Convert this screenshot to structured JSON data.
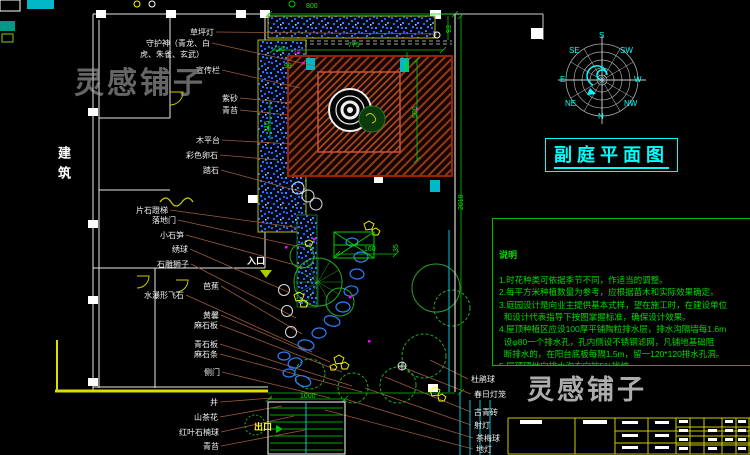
{
  "title": {
    "text": "副庭平面图"
  },
  "building_label": {
    "text": "建筑"
  },
  "entrance": {
    "t": "入口",
    "x": 247,
    "y": 257
  },
  "exit": {
    "t": "出口",
    "x": 254,
    "y": 423
  },
  "watermarks": [
    {
      "t": "灵感铺子",
      "x": 74,
      "y": 58,
      "variant": "dark"
    },
    {
      "t": "灵感铺子",
      "x": 527,
      "y": 368,
      "variant": "light"
    }
  ],
  "notes": {
    "heading": "说明",
    "lines": [
      "1.时花种类可依据季节不同，作适当的调整。",
      "2.每平方米种植数量为参考，应根据苗木和实际效果确定。",
      "3.庭园设计是向业主提供基本式样，望在施工时，在建设单位",
      "  和设计代表指导下按图掌握标准，确保设计效果。",
      "4.屋顶种植区应设100厚平铺陶粒排水层，排水沟隔墙每1.6m",
      "  设φ80一个排水孔，孔内侧设不锈钢滤网，凡铺地基础阻",
      "  断排水的，在阳台底板每隔1.5m，留一120*120排水孔洞。",
      "5.屋顶硬地向排水沟方向按5%找坡。",
      "6.铺地基础详见施工图。"
    ]
  },
  "compass": {
    "dirs": [
      {
        "t": "S",
        "x": 599,
        "y": 32
      },
      {
        "t": "SE",
        "x": 569,
        "y": 47
      },
      {
        "t": "E",
        "x": 560,
        "y": 76
      },
      {
        "t": "NE",
        "x": 565,
        "y": 100
      },
      {
        "t": "N",
        "x": 598,
        "y": 113
      },
      {
        "t": "NW",
        "x": 624,
        "y": 100
      },
      {
        "t": "W",
        "x": 634,
        "y": 76
      },
      {
        "t": "SW",
        "x": 620,
        "y": 47
      }
    ]
  },
  "plan_labels": {
    "left": [
      {
        "t": "草坪灯",
        "rx": 214,
        "y": 28,
        "lx": 437,
        "ly": 34
      },
      {
        "t": "守护神（青龙、白",
        "rx": 210,
        "y": 39,
        "lx": 315,
        "ly": 66
      },
      {
        "t": "虎、朱雀、玄武）",
        "rx": 204,
        "y": 50
      },
      {
        "t": "宣传栏",
        "rx": 220,
        "y": 66,
        "lx": 300,
        "ly": 88
      },
      {
        "t": "紫砂",
        "rx": 238,
        "y": 94,
        "lx": 292,
        "ly": 103
      },
      {
        "t": "青苔",
        "rx": 238,
        "y": 106,
        "lx": 288,
        "ly": 115
      },
      {
        "t": "木平台",
        "rx": 220,
        "y": 136,
        "lx": 292,
        "ly": 144
      },
      {
        "t": "彩色卵石",
        "rx": 218,
        "y": 151,
        "lx": 278,
        "ly": 160
      },
      {
        "t": "踏石",
        "rx": 219,
        "y": 166,
        "lx": 302,
        "ly": 192
      },
      {
        "t": "片石蹬梯",
        "rx": 168,
        "y": 206,
        "lx": 300,
        "ly": 228
      },
      {
        "t": "落地门",
        "rx": 176,
        "y": 216,
        "lx": 305,
        "ly": 248
      },
      {
        "t": "小石笋",
        "rx": 184,
        "y": 231,
        "lx": 306,
        "ly": 268
      },
      {
        "t": "绣球",
        "rx": 188,
        "y": 245,
        "lx": 288,
        "ly": 292
      },
      {
        "t": "石雕狮子",
        "rx": 189,
        "y": 260,
        "lx": 296,
        "ly": 318
      },
      {
        "t": "芭蕉",
        "rx": 219,
        "y": 282,
        "lx": 302,
        "ly": 334
      },
      {
        "t": "水瀑形飞石",
        "rx": 184,
        "y": 291,
        "lx": 312,
        "ly": 352
      },
      {
        "t": "黄馨",
        "rx": 219,
        "y": 311,
        "lx": 330,
        "ly": 362
      },
      {
        "t": "麻石板",
        "rx": 218,
        "y": 321,
        "lx": 342,
        "ly": 372
      },
      {
        "t": "青石板",
        "rx": 218,
        "y": 340,
        "lx": 352,
        "ly": 386
      },
      {
        "t": "麻石条",
        "rx": 218,
        "y": 350,
        "lx": 362,
        "ly": 392
      },
      {
        "t": "侧门",
        "rx": 220,
        "y": 368,
        "lx": 330,
        "ly": 398
      }
    ],
    "bottom_left": [
      {
        "t": "井",
        "rx": 218,
        "y": 398,
        "lx": 272,
        "ly": 398
      },
      {
        "t": "山茶花",
        "rx": 218,
        "y": 413,
        "lx": 282,
        "ly": 406
      },
      {
        "t": "红叶石楠球",
        "rx": 219,
        "y": 428,
        "lx": 294,
        "ly": 416
      },
      {
        "t": "青苔",
        "rx": 219,
        "y": 442,
        "lx": 305,
        "ly": 430
      }
    ],
    "right": [
      {
        "t": "杜鹃球",
        "x": 471,
        "y": 375,
        "lx": 430,
        "ly": 360
      },
      {
        "t": "春日灯笼",
        "x": 474,
        "y": 390,
        "lx": 405,
        "ly": 368
      },
      {
        "t": "古青砖",
        "x": 474,
        "y": 408,
        "lx": 385,
        "ly": 377
      },
      {
        "t": "射灯",
        "x": 474,
        "y": 421,
        "lx": 365,
        "ly": 388
      },
      {
        "t": "茶梅球",
        "x": 476,
        "y": 434,
        "lx": 345,
        "ly": 399
      },
      {
        "t": "地灯",
        "x": 476,
        "y": 445,
        "lx": 325,
        "ly": 410
      }
    ]
  },
  "dimensions": [
    {
      "t": "800",
      "x": 306,
      "y": 3
    },
    {
      "t": "775",
      "x": 348,
      "y": 42
    },
    {
      "t": "98",
      "x": 284,
      "y": 63
    },
    {
      "t": "16",
      "x": 277,
      "y": 46
    },
    {
      "t": "14",
      "x": 293,
      "y": 49,
      "c": "#ff00ff"
    },
    {
      "t": "93",
      "x": 446,
      "y": 33,
      "rot": 90
    },
    {
      "t": "68",
      "x": 404,
      "y": 70,
      "rot": 90
    },
    {
      "t": "500",
      "x": 412,
      "y": 118,
      "rot": 90
    },
    {
      "t": "116",
      "x": 264,
      "y": 132,
      "rot": 90
    },
    {
      "t": "2010",
      "x": 458,
      "y": 210,
      "rot": 90
    },
    {
      "t": "160",
      "x": 364,
      "y": 246
    },
    {
      "t": "35",
      "x": 393,
      "y": 252,
      "rot": 90
    },
    {
      "t": "1000",
      "x": 300,
      "y": 393
    }
  ]
}
